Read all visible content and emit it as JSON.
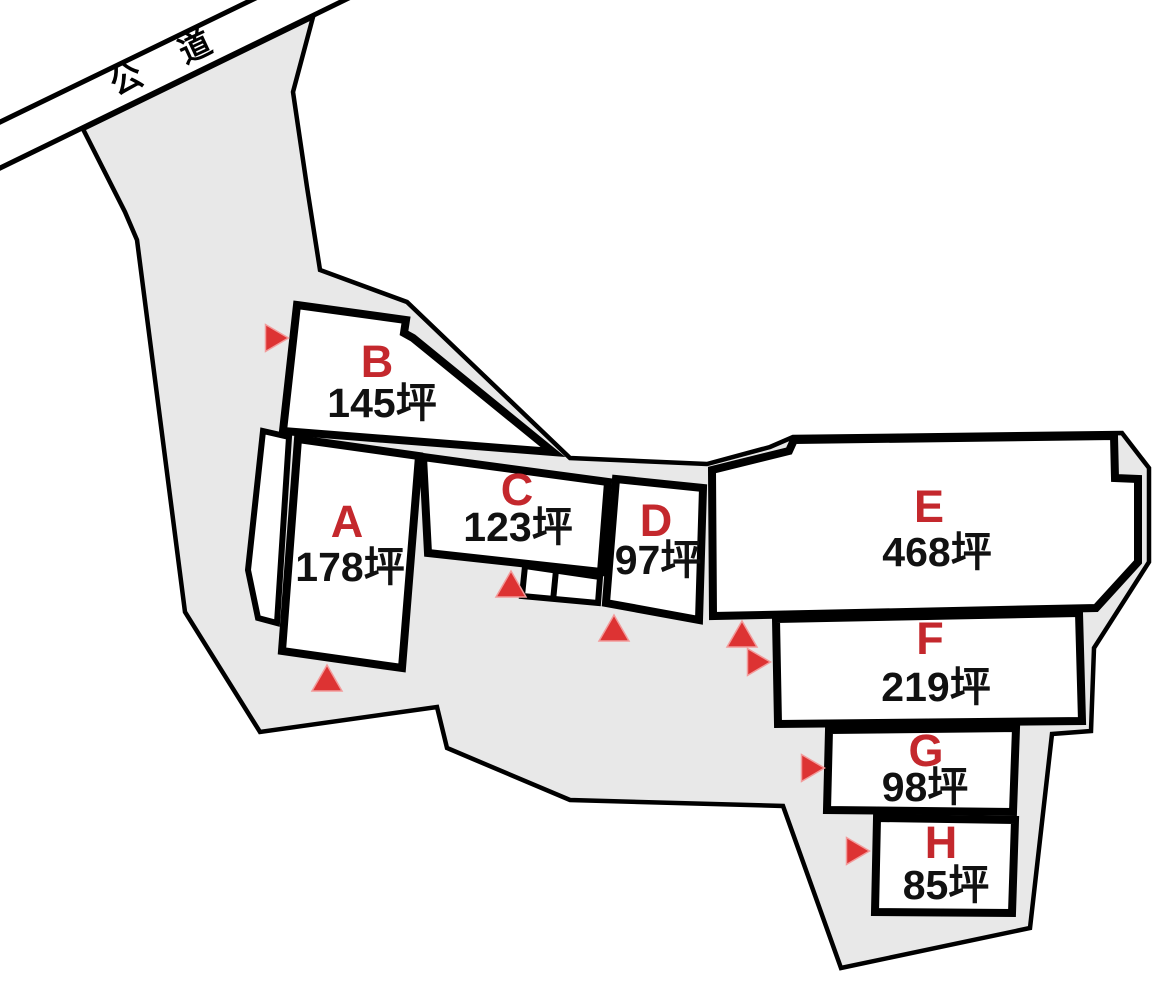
{
  "map_title": "residential-lot-subdivision-map",
  "colors": {
    "background": "#ffffff",
    "parcel_fill": "#e8e8e8",
    "parcel_stroke": "#000000",
    "plot_fill": "#ffffff",
    "plot_stroke": "#000000",
    "label_red": "#c4282d",
    "marker_red": "#dd3333",
    "marker_halo": "#f29b9b",
    "area_text": "#111111",
    "road_stroke": "#000000"
  },
  "road": {
    "label": "公　道",
    "label_x": 168,
    "label_y": 72,
    "label_angle": -25,
    "label_size": 32,
    "letter_spacing": 6,
    "lines": [
      {
        "x1": -6,
        "y1": 125,
        "x2": 264,
        "y2": -6
      },
      {
        "x1": -6,
        "y1": 171,
        "x2": 357,
        "y2": -6
      }
    ],
    "stroke_width": 5
  },
  "parcel": {
    "points": "83,129 313,17 293,92 307,187 320,270 407,302 570,458 707,464 770,447 793,437 1122,433 1149,468 1149,562 1094,648 1091,731 1052,734 1030,928 841,968 783,806 570,800 447,748 437,707 260,732 185,612 137,240 125,212",
    "stroke_width": 4.5
  },
  "plots": [
    {
      "id": "A",
      "letter": "A",
      "area_label": "178坪",
      "points": "298,439 419,456 402,668 282,651",
      "letter_x": 347,
      "letter_y": 537,
      "area_x": 350,
      "area_y": 581
    },
    {
      "id": "B",
      "letter": "B",
      "area_label": "145坪",
      "points": "297,305 406,320 404,333 413,338 553,452 283,431",
      "letter_x": 377,
      "letter_y": 377,
      "area_x": 382,
      "area_y": 417
    },
    {
      "id": "C",
      "letter": "C",
      "area_label": "123坪",
      "points": "423,457 608,482 601,572 428,553",
      "letter_x": 517,
      "letter_y": 505,
      "area_x": 518,
      "area_y": 541
    },
    {
      "id": "D",
      "letter": "D",
      "area_label": "97坪",
      "points": "616,479 703,488 699,620 606,603",
      "letter_x": 656,
      "letter_y": 536,
      "area_x": 658,
      "area_y": 574
    },
    {
      "id": "E",
      "letter": "E",
      "area_label": "468坪",
      "points": "712,470 789,451 794,440 1114,436 1115,478 1138,479 1138,562 1096,608 713,616",
      "letter_x": 929,
      "letter_y": 522,
      "area_x": 937,
      "area_y": 566
    },
    {
      "id": "F",
      "letter": "F",
      "area_label": "219坪",
      "points": "776,619 1079,613 1082,721 778,724",
      "letter_x": 930,
      "letter_y": 654,
      "area_x": 936,
      "area_y": 701
    },
    {
      "id": "G",
      "letter": "G",
      "area_label": "98坪",
      "points": "829,730 1016,728 1013,812 827,810",
      "letter_x": 926,
      "letter_y": 766,
      "area_x": 925,
      "area_y": 801
    },
    {
      "id": "H",
      "letter": "H",
      "area_label": "85坪",
      "points": "877,818 1015,820 1012,913 875,912",
      "letter_x": 941,
      "letter_y": 858,
      "area_x": 946,
      "area_y": 899
    }
  ],
  "plot_style": {
    "stroke_width": 8,
    "letter_size": 45,
    "area_size": 41
  },
  "extras": {
    "access_strip": {
      "points": "263,431 289,437 277,623 258,618 248,570",
      "stroke_width": 6
    },
    "c_annex": {
      "points": "525,566 600,577 598,603 522,596",
      "divider": {
        "x1": 556,
        "y1": 570,
        "x2": 553,
        "y2": 601
      },
      "stroke_width": 6
    }
  },
  "markers": [
    {
      "name": "marker-b",
      "dir": "right",
      "x": 277,
      "y": 338
    },
    {
      "name": "marker-a",
      "dir": "up",
      "x": 327,
      "y": 678
    },
    {
      "name": "marker-c",
      "dir": "up",
      "x": 511,
      "y": 584
    },
    {
      "name": "marker-d",
      "dir": "up",
      "x": 614,
      "y": 628
    },
    {
      "name": "marker-e",
      "dir": "up",
      "x": 742,
      "y": 634
    },
    {
      "name": "marker-f",
      "dir": "right",
      "x": 759,
      "y": 662
    },
    {
      "name": "marker-g",
      "dir": "right",
      "x": 813,
      "y": 768
    },
    {
      "name": "marker-h",
      "dir": "right",
      "x": 858,
      "y": 851
    }
  ],
  "marker_size": {
    "up_w": 30,
    "up_h": 26,
    "right_w": 23,
    "right_h": 27
  }
}
